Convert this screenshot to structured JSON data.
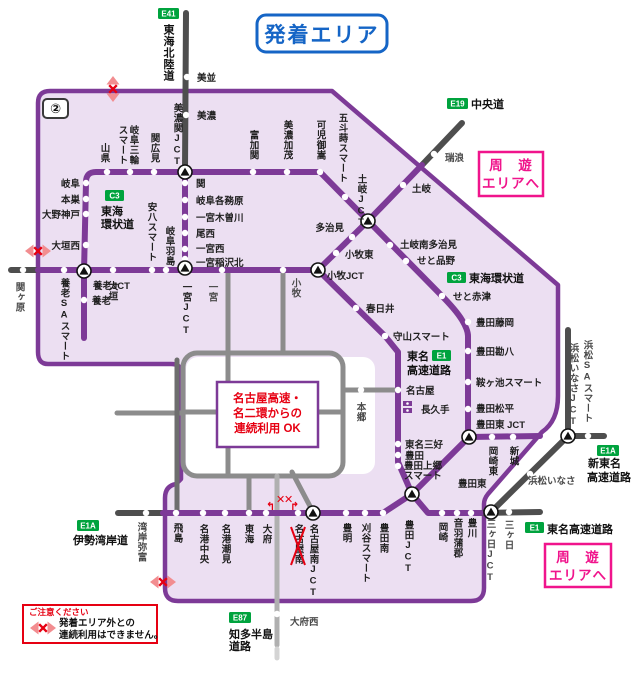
{
  "title": "発着エリア",
  "area_number": "②",
  "colors": {
    "purple": "#7d3a97",
    "area_fill": "#ecdff2",
    "blue": "#1565c6",
    "pink": "#f0148c",
    "red": "#e60012",
    "badge_green": "#00a33e",
    "gray_dark": "#4e4e4e",
    "gray_city": "#8c8c8c"
  },
  "badges": {
    "e41": "E41",
    "e19": "E19",
    "c3_west": "C3",
    "c3_east": "C3",
    "e1_tomei": "E1",
    "e1_bottom": "E1",
    "e1a_isewangan": "E1A",
    "e1a_shintomei": "E1A",
    "e87": "E87"
  },
  "roads": {
    "tokai_hokuriku": "東海北陸道",
    "chuo": "中央道",
    "tokai_kanjo_w1": "東海",
    "tokai_kanjo_w2": "環状道",
    "tokai_kanjo_e": "東海環状道",
    "tomei_1": "東名",
    "tomei_2": "高速道路",
    "tomei_bottom": "東名高速道路",
    "shintomei_1": "新東名",
    "shintomei_2": "高速道路",
    "isewangan": "伊勢湾岸道",
    "chita_1": "知多半島",
    "chita_2": "道路"
  },
  "stations": {
    "minami": "美並",
    "mino": "美濃",
    "yamagata": "山県",
    "gifumiwa1": "岐阜三輪",
    "gifumiwa2": "スマート",
    "sekihiromi": "関広見",
    "minoseki_jct": "美濃関JCT",
    "tomikaseki": "富加関",
    "minokamo": "美濃加茂",
    "kanimitake": "可児御嵩",
    "gotomaki": "五斗蒔スマート",
    "toki_jct": "土岐JCT",
    "toki": "土岐",
    "mizunami": "瑞浪",
    "gifu": "岐阜",
    "motosu": "本巣",
    "onogodo": "大野神戸",
    "ogaki_nishi": "大垣西",
    "sekigahara": "関ヶ原",
    "yoro_jct": "養老JCT",
    "yoro": "養老",
    "yoro_sa": "養老SAスマート",
    "ogaki": "大垣",
    "anpachi": "安八スマート",
    "gifu_hashima": "岐阜羽島",
    "seki": "関",
    "kakamigahara": "岐阜各務原",
    "kisogawa": "一宮木曽川",
    "bisai": "尾西",
    "ichinomiya_nishi": "一宮西",
    "inazawa_kita": "一宮稲沢北",
    "ichinomiya_jct": "一宮JCT",
    "ichinomiya": "一宮",
    "komaki": "小牧",
    "komaki_jct": "小牧JCT",
    "komaki_higashi": "小牧東",
    "tajimi": "多治見",
    "toki_minami_tajimi": "土岐南多治見",
    "seto_shinano": "せと品野",
    "seto_akazu": "せと赤津",
    "toyota_fujioka": "豊田藤岡",
    "toyota_kanpachi": "豊田勘八",
    "kuragaike": "鞍ヶ池スマート",
    "toyota_matsudaira": "豊田松平",
    "toyota_higashi_jct": "豊田東 JCT",
    "kasugai": "春日井",
    "moriyama": "守山スマート",
    "nagoya": "名古屋",
    "nagakute": "長久手",
    "hongo": "本郷",
    "tomei_miyoshi": "東名三好",
    "toyota": "豊田",
    "kamigo1": "豊田上郷",
    "kamigo2": "スマート",
    "okazaki_higashi": "岡崎東",
    "shinshiro": "新城",
    "hamamatsu_inasa_jct": "浜松いなさJCT",
    "hamamatsu_sa": "浜松SAスマート",
    "hamamatsu_inasa": "浜松いなさ",
    "wangan_yatomi": "湾岸弥富",
    "tobishima": "飛島",
    "meiko_chuo": "名港中央",
    "meiko_shiomi": "名港潮見",
    "tokai": "東海",
    "obu": "大府",
    "nagoya_minami": "名古屋南",
    "nagoya_minami_jct": "名古屋南JCT",
    "toyoake": "豊明",
    "kariya_smart": "刈谷スマート",
    "toyota_minami": "豊田南",
    "toyota_jct": "豊田JCT",
    "toyota_higashi": "豊田東",
    "okazaki": "岡崎",
    "otowa_gamagori": "音羽蒲郡",
    "toyokawa": "豊川",
    "mikkabi_jct": "三ヶ日JCT",
    "mikkabi": "三ヶ日",
    "obu_nishi": "大府西"
  },
  "boxes": {
    "shuyu_top": {
      "line1": "周　遊",
      "line2": "エリアへ"
    },
    "shuyu_bottom": {
      "line1": "周　遊",
      "line2": "エリアへ"
    },
    "renzoku_ok": {
      "line1": "名古屋高速・",
      "line2": "名二環からの",
      "line3": "連続利用 OK"
    },
    "caution": {
      "title": "ご注意ください",
      "line1": "発着エリア外との",
      "line2": "連続利用はできません。"
    }
  }
}
